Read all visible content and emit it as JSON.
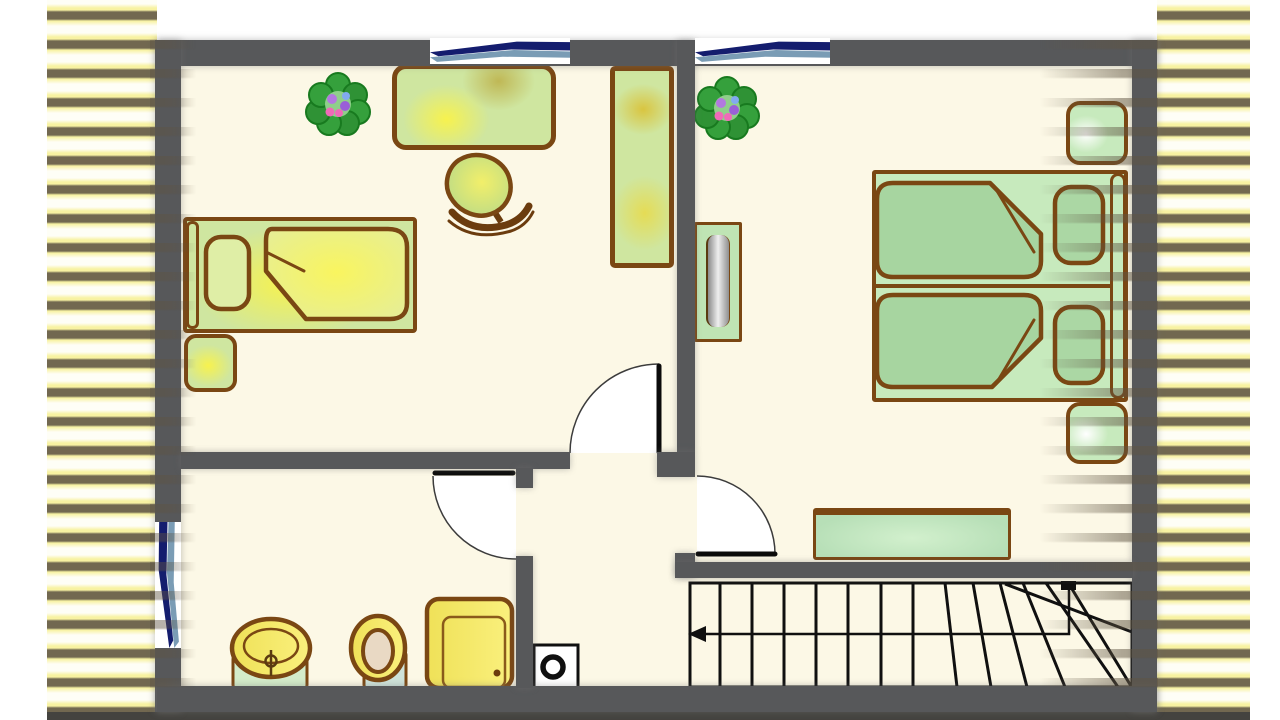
{
  "title": "upper-floor-plan",
  "palette": {
    "wall": "#57585a",
    "floor": "#fcf8e6",
    "ink": "#101010",
    "outline": "#7a4713",
    "green": "#cfe6a0",
    "glow": "#f7f24e",
    "mint": "#c7eabd",
    "sage": "#a7d5a0",
    "bathy": "#f2e468",
    "paleg": "#d4ecca",
    "paleb": "#cfe3da",
    "navy": "#141d6e",
    "steel": "#7a9cb5",
    "hatchy": "#f8f2a2",
    "hatchd": "#6b6156"
  },
  "rooms": [
    {
      "name": "left-bedroom",
      "items": [
        {
          "name": "flower-plant"
        },
        {
          "name": "desk"
        },
        {
          "name": "swivel-chair"
        },
        {
          "name": "tall-wardrobe"
        },
        {
          "name": "single-bed"
        },
        {
          "name": "pillow"
        },
        {
          "name": "folded-blanket"
        },
        {
          "name": "bedside-table"
        }
      ]
    },
    {
      "name": "right-bedroom",
      "items": [
        {
          "name": "flower-plant"
        },
        {
          "name": "mirror-commode"
        },
        {
          "name": "double-bed"
        },
        {
          "name": "blanket-upper"
        },
        {
          "name": "blanket-lower"
        },
        {
          "name": "pillow-upper"
        },
        {
          "name": "pillow-lower"
        },
        {
          "name": "nightstand-upper"
        },
        {
          "name": "nightstand-lower"
        },
        {
          "name": "bench-chest"
        }
      ]
    },
    {
      "name": "bathroom",
      "items": [
        {
          "name": "washbasin"
        },
        {
          "name": "toilet"
        },
        {
          "name": "shower-cabin"
        }
      ]
    },
    {
      "name": "hallway",
      "items": [
        {
          "name": "ventilation-box"
        }
      ]
    },
    {
      "name": "staircase",
      "items": [
        {
          "name": "winder-stairs"
        },
        {
          "name": "walking-line-arrow"
        }
      ]
    }
  ],
  "windows": [
    {
      "name": "top-window-left-room"
    },
    {
      "name": "top-window-right-room"
    },
    {
      "name": "bathroom-window"
    }
  ],
  "doors": [
    {
      "name": "left-bedroom-door"
    },
    {
      "name": "bathroom-door"
    },
    {
      "name": "right-bedroom-door"
    }
  ],
  "stairs": {
    "straight_treads": 8,
    "winder_treads": 7,
    "arrow_direction": "left"
  }
}
